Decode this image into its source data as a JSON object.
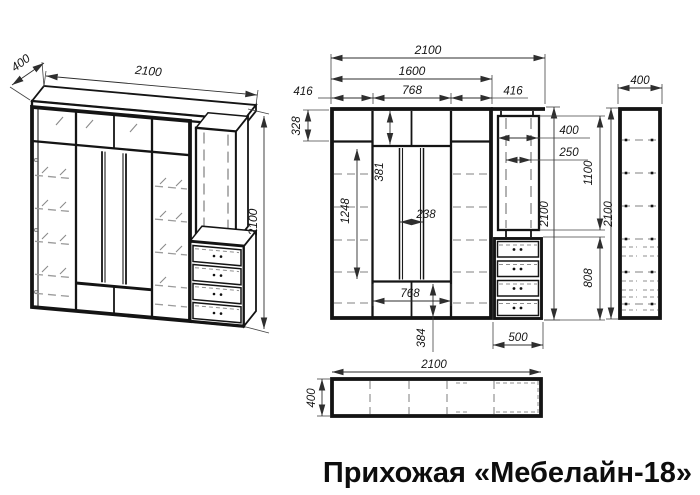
{
  "title": "Прихожая «Мебелайн-18»",
  "views": {
    "iso": {
      "depth": "400",
      "width": "2100",
      "height": "2100"
    },
    "front": {
      "total_width": "2100",
      "main_width": "1600",
      "middle_width": "768",
      "left_col_width": "416",
      "right_col_width": "416",
      "top_row_height": "328",
      "middle_top_height": "381",
      "mirror_col_height": "1248",
      "mirror_gap_width": "238",
      "bottom_middle_width": "768",
      "bottom_row_height": "384",
      "total_height": "2100",
      "panel_width": "400",
      "panel_offset": "250",
      "panel_height": "1100",
      "drawer_height": "808",
      "drawer_width": "500"
    },
    "side": {
      "depth": "400",
      "height": "2100"
    },
    "top": {
      "width": "2100",
      "depth": "400"
    }
  }
}
